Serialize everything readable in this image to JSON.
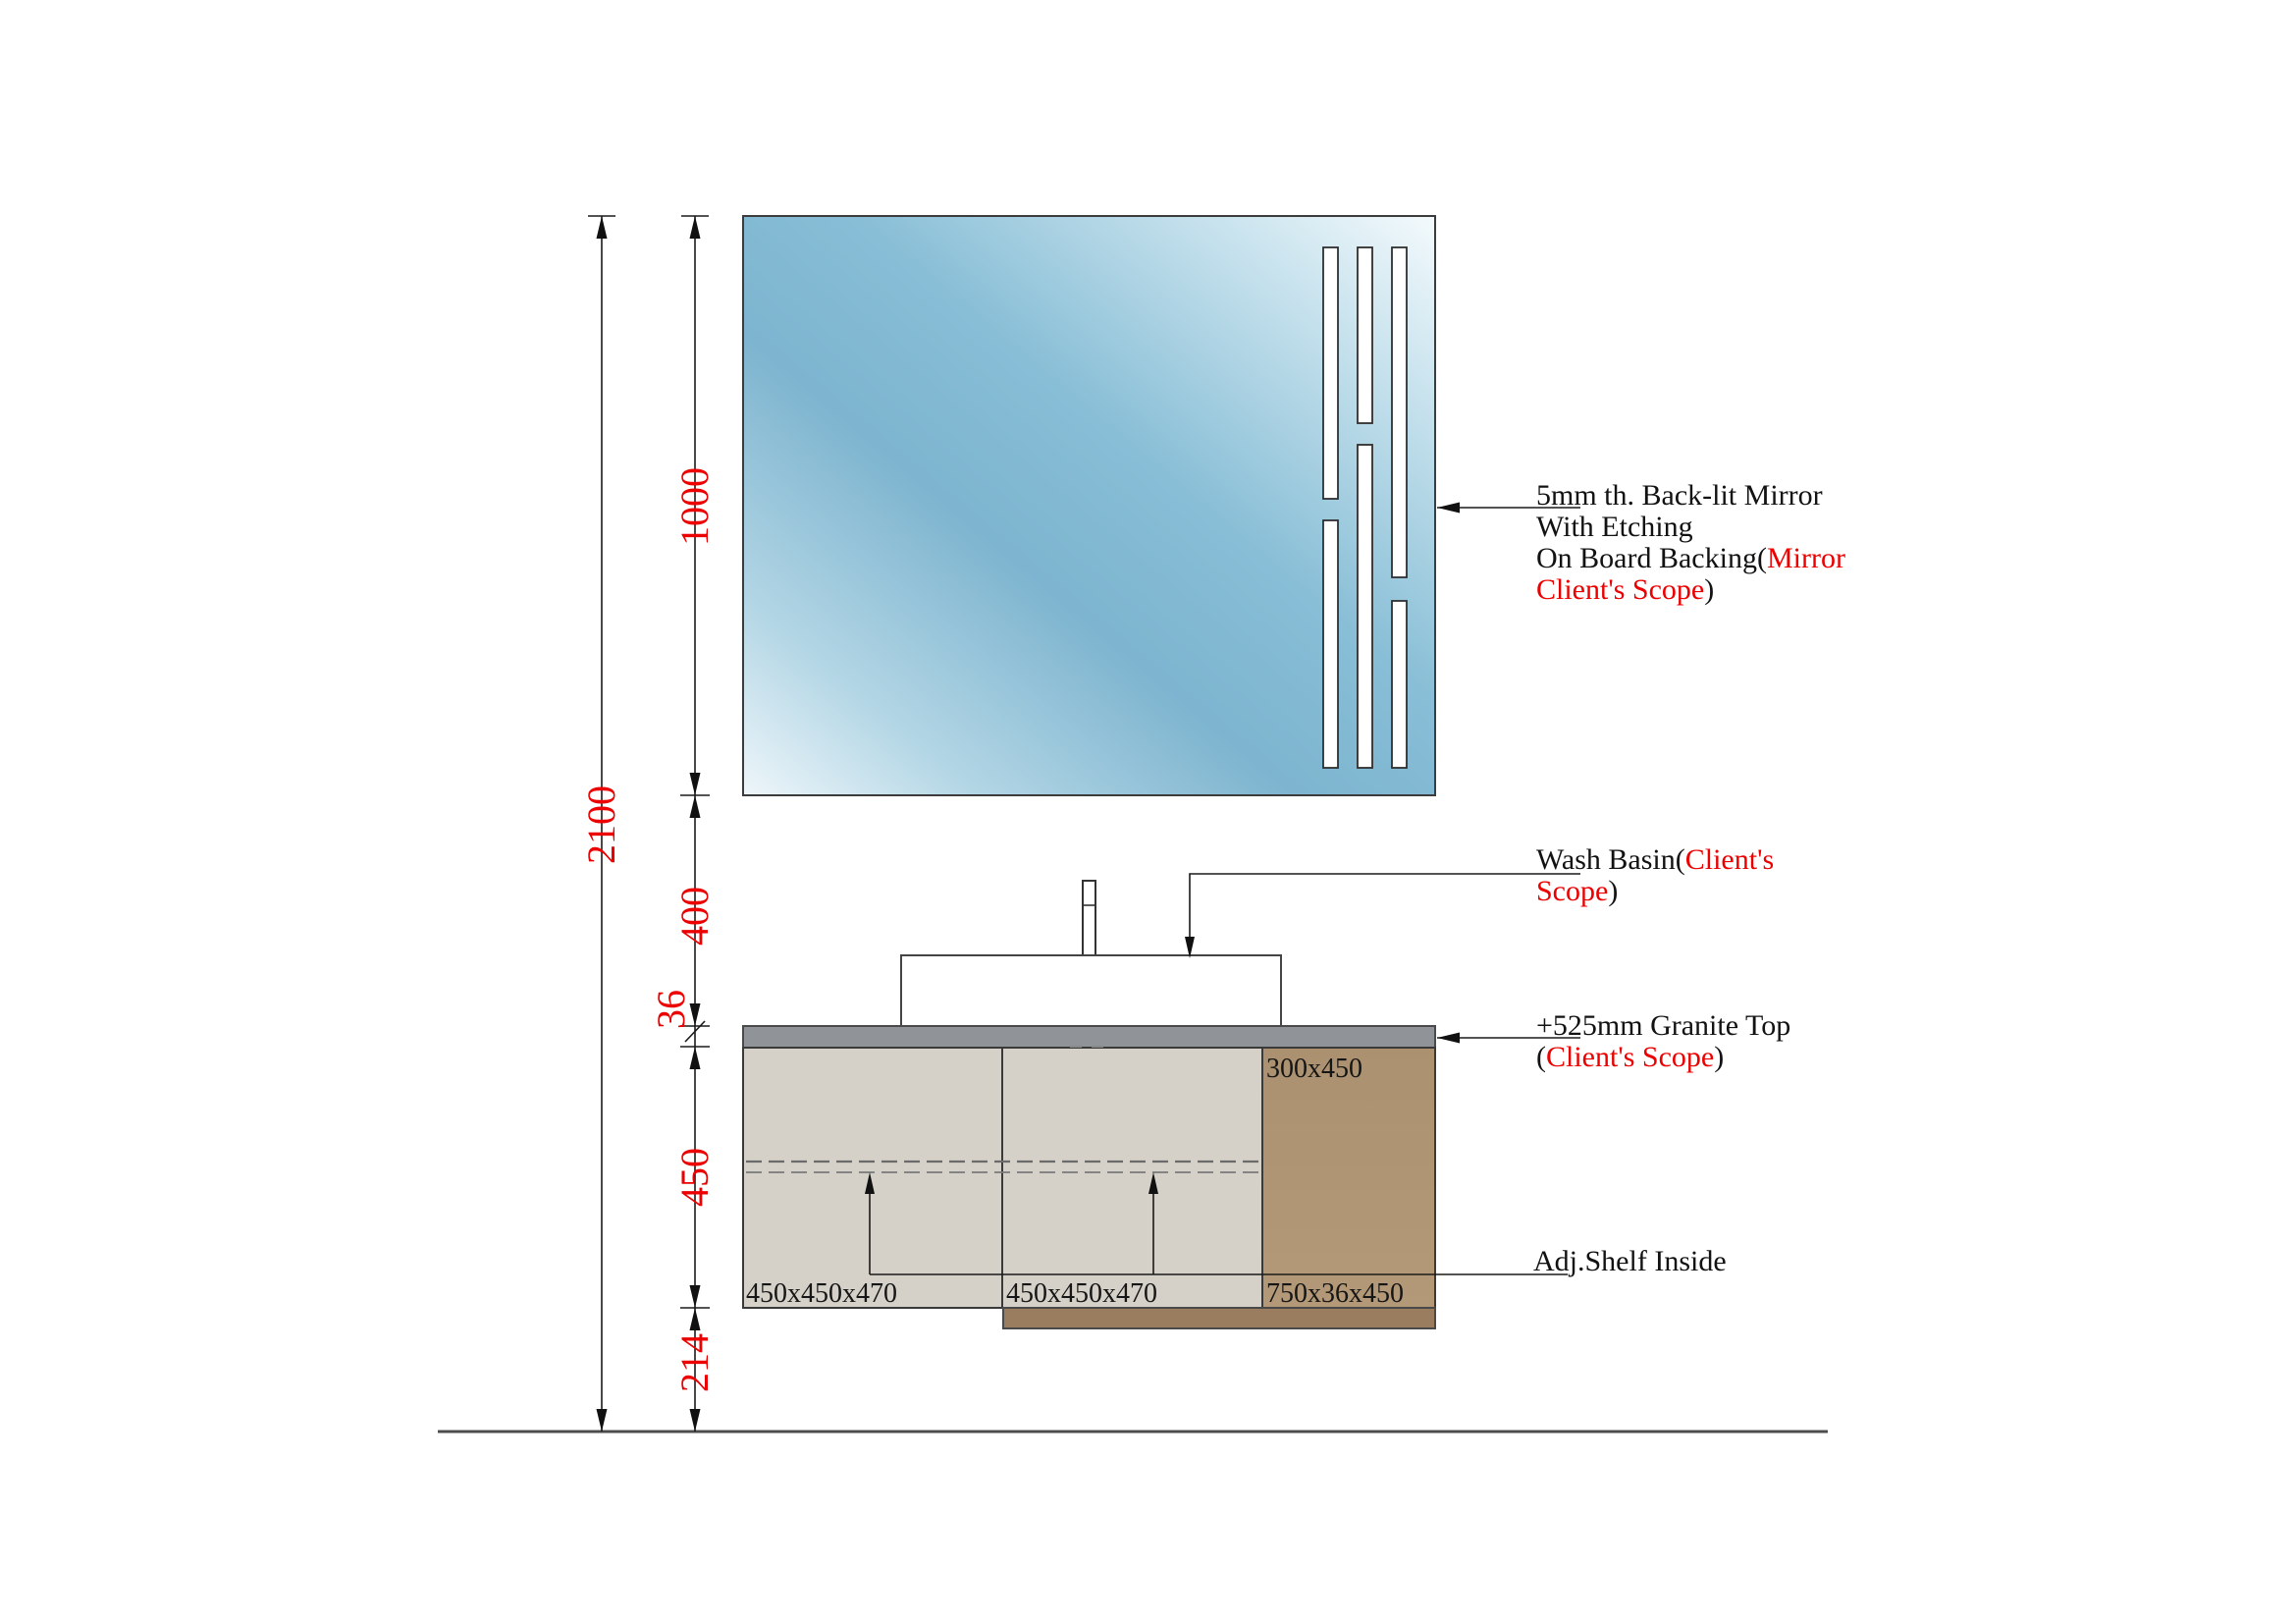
{
  "drawing": {
    "dims": {
      "total": "2100",
      "mirror": "1000",
      "gap": "400",
      "granite": "36",
      "cabinet": "450",
      "clearance": "214"
    },
    "mirror_note": {
      "l1": "5mm th. Back-lit Mirror",
      "l2": "With Etching",
      "l3_black": "On Board Backing(",
      "l3_red": "Mirror",
      "l4_red": "Client's Scope",
      "l4_black": ")"
    },
    "basin_note": {
      "l1_black": "Wash Basin(",
      "l1_red": "Client's",
      "l2_red": "Scope",
      "l2_black": ")"
    },
    "granite_note": {
      "l1": "+525mm Granite Top",
      "l2_open": "(",
      "l2_red": "Client's Scope",
      "l2_close": ")"
    },
    "shelf_note": "Adj.Shelf Inside",
    "labels": {
      "left_cabinet": "450x450x470",
      "mid_cabinet": "450x450x470",
      "side_panel": "750x36x450",
      "upper_panel": "300x450"
    },
    "colors": {
      "red": "#ec0000",
      "line": "#1a1a1a",
      "mirror_blue": "#7db4cf",
      "granite_gray": "#909499",
      "cabinet_beige": "#d5d1c8",
      "cabinet_brown": "#ab9170",
      "plinth_brown": "#9a7c5e"
    }
  }
}
